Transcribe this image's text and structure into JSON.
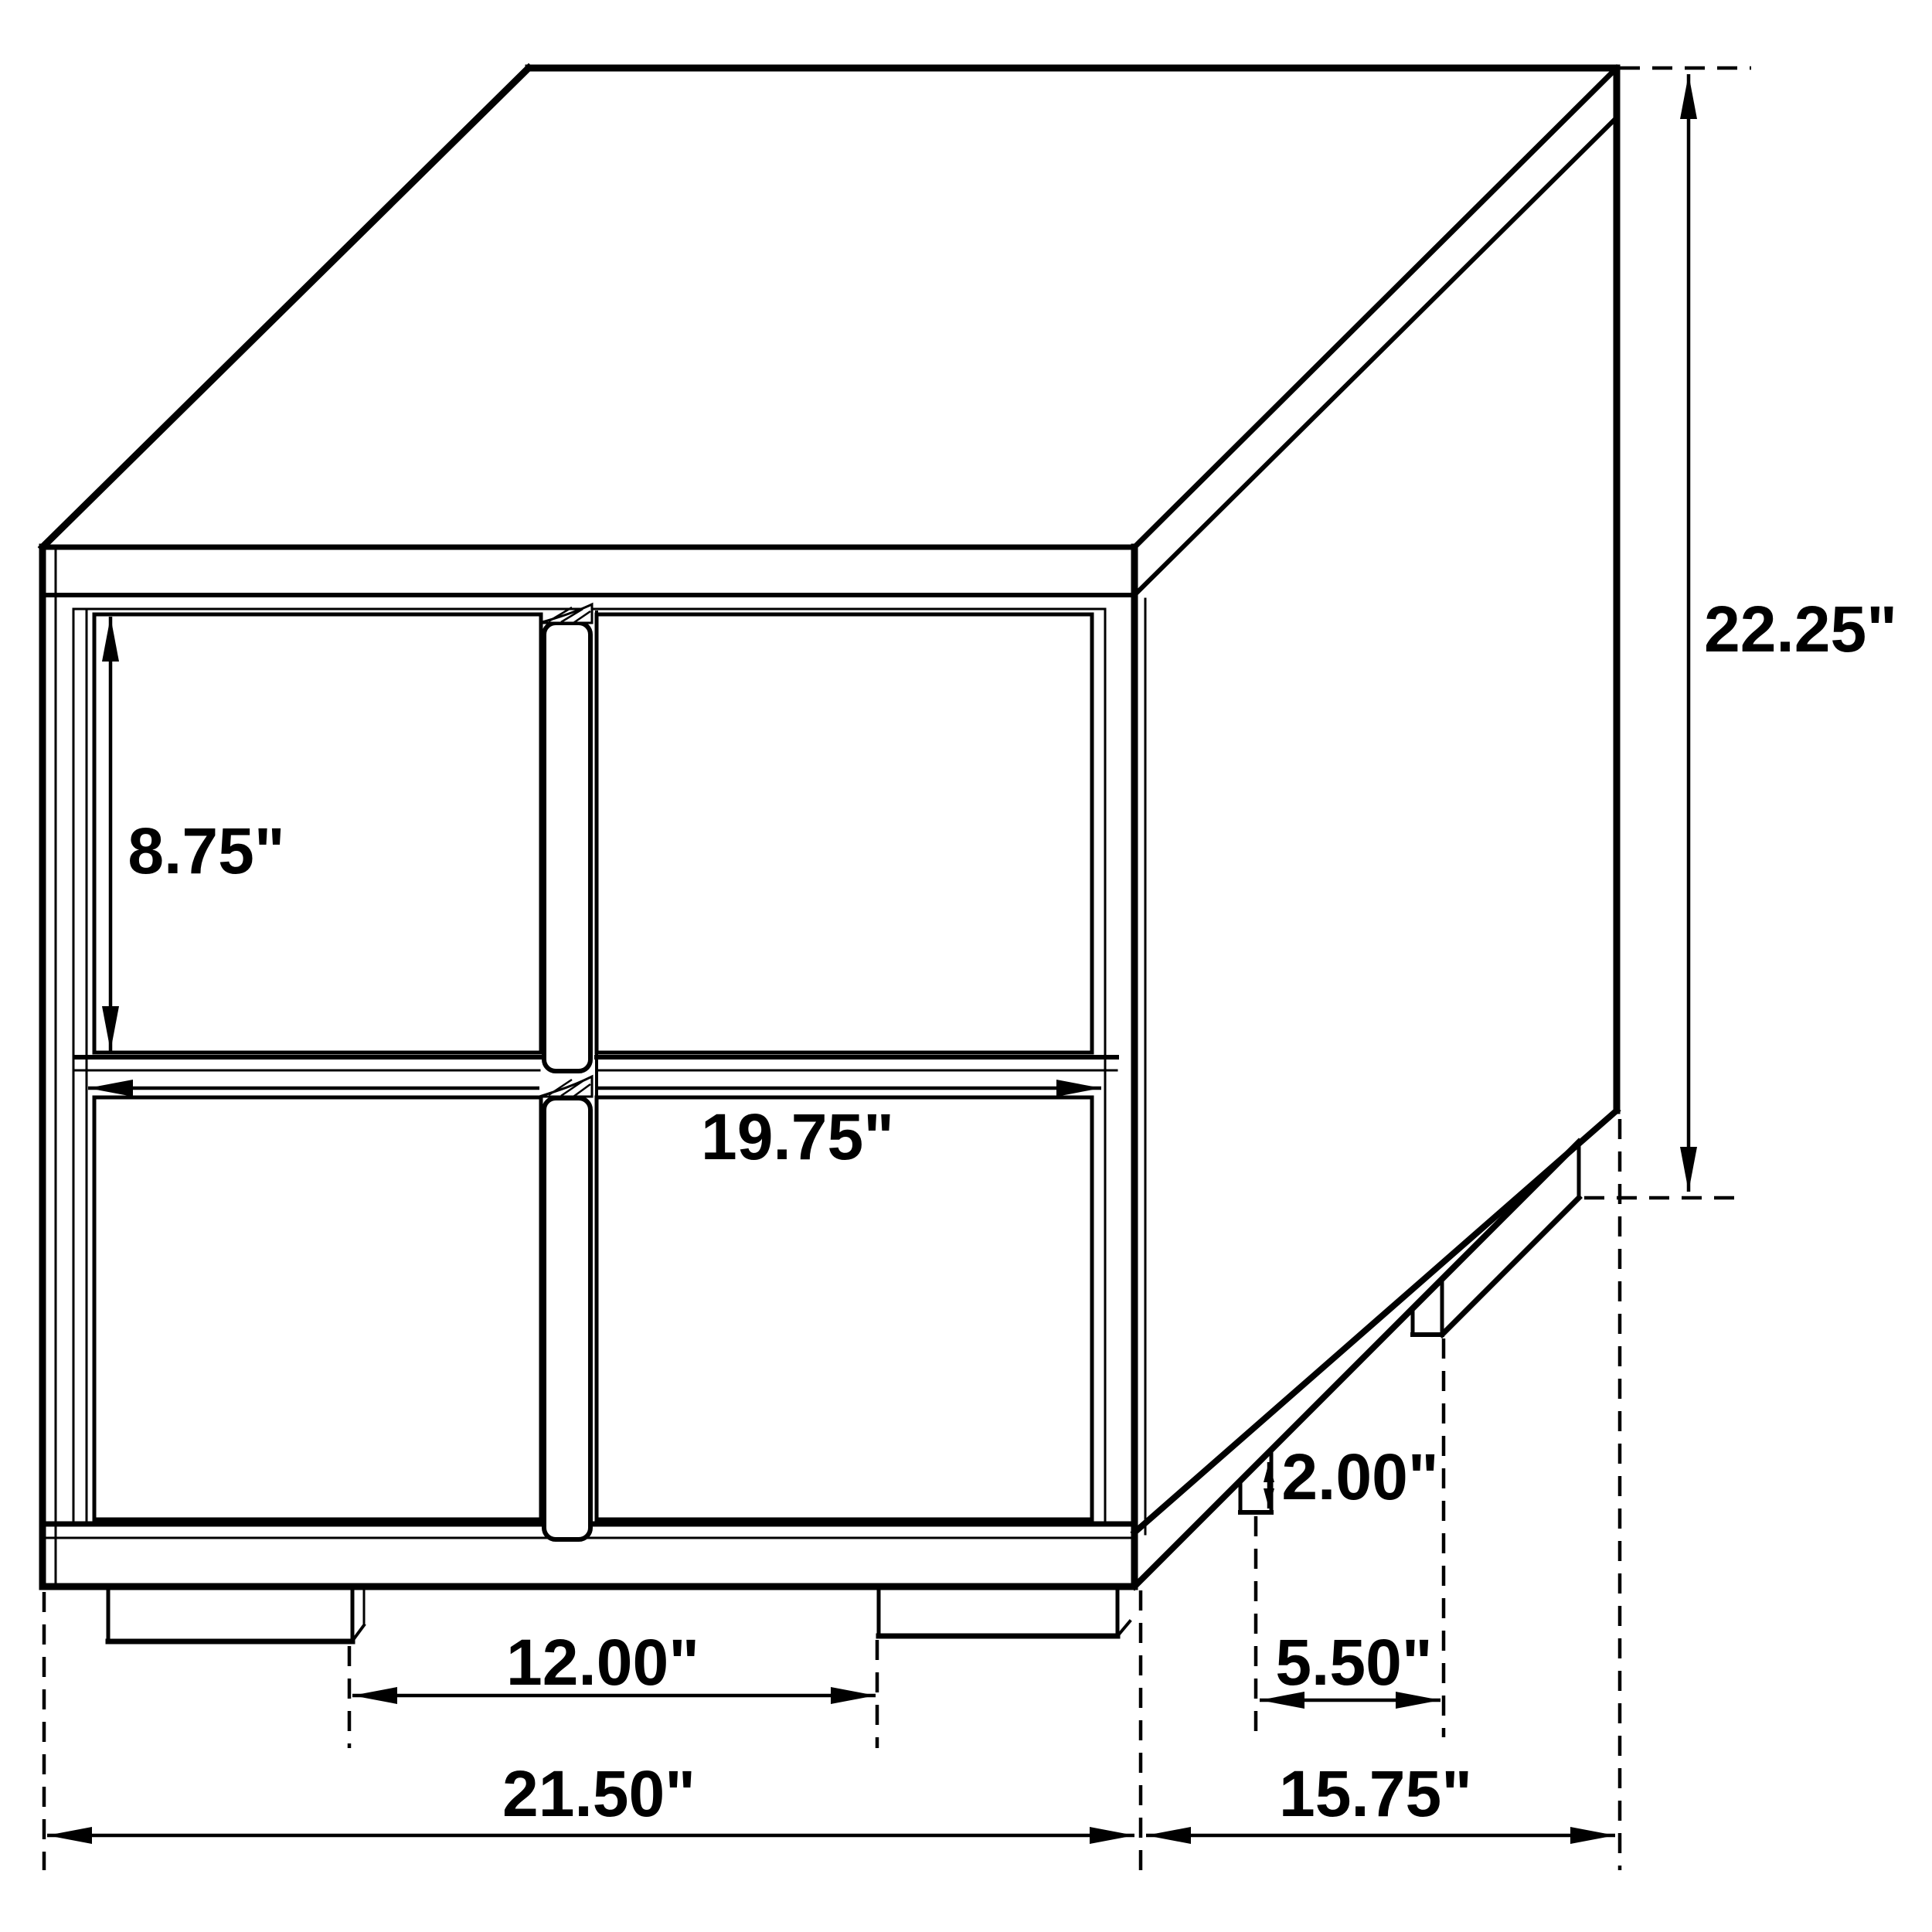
{
  "diagram": {
    "title": "Nightstand dimension line drawing",
    "type": "furniture-dimension-drawing",
    "view": "isometric line art, front-left view, two-drawer nightstand",
    "units": "inches",
    "background_color": "#ffffff",
    "line_color": "#000000",
    "dimensions": {
      "drawer_front_height": "8.75\"",
      "drawer_width": "19.75\"",
      "overall_height": "22.25\"",
      "leg_height": "2.00\"",
      "side_leg_spacing": "5.50\"",
      "front_leg_spacing": "12.00\"",
      "overall_width": "21.50\"",
      "overall_depth": "15.75\""
    }
  }
}
